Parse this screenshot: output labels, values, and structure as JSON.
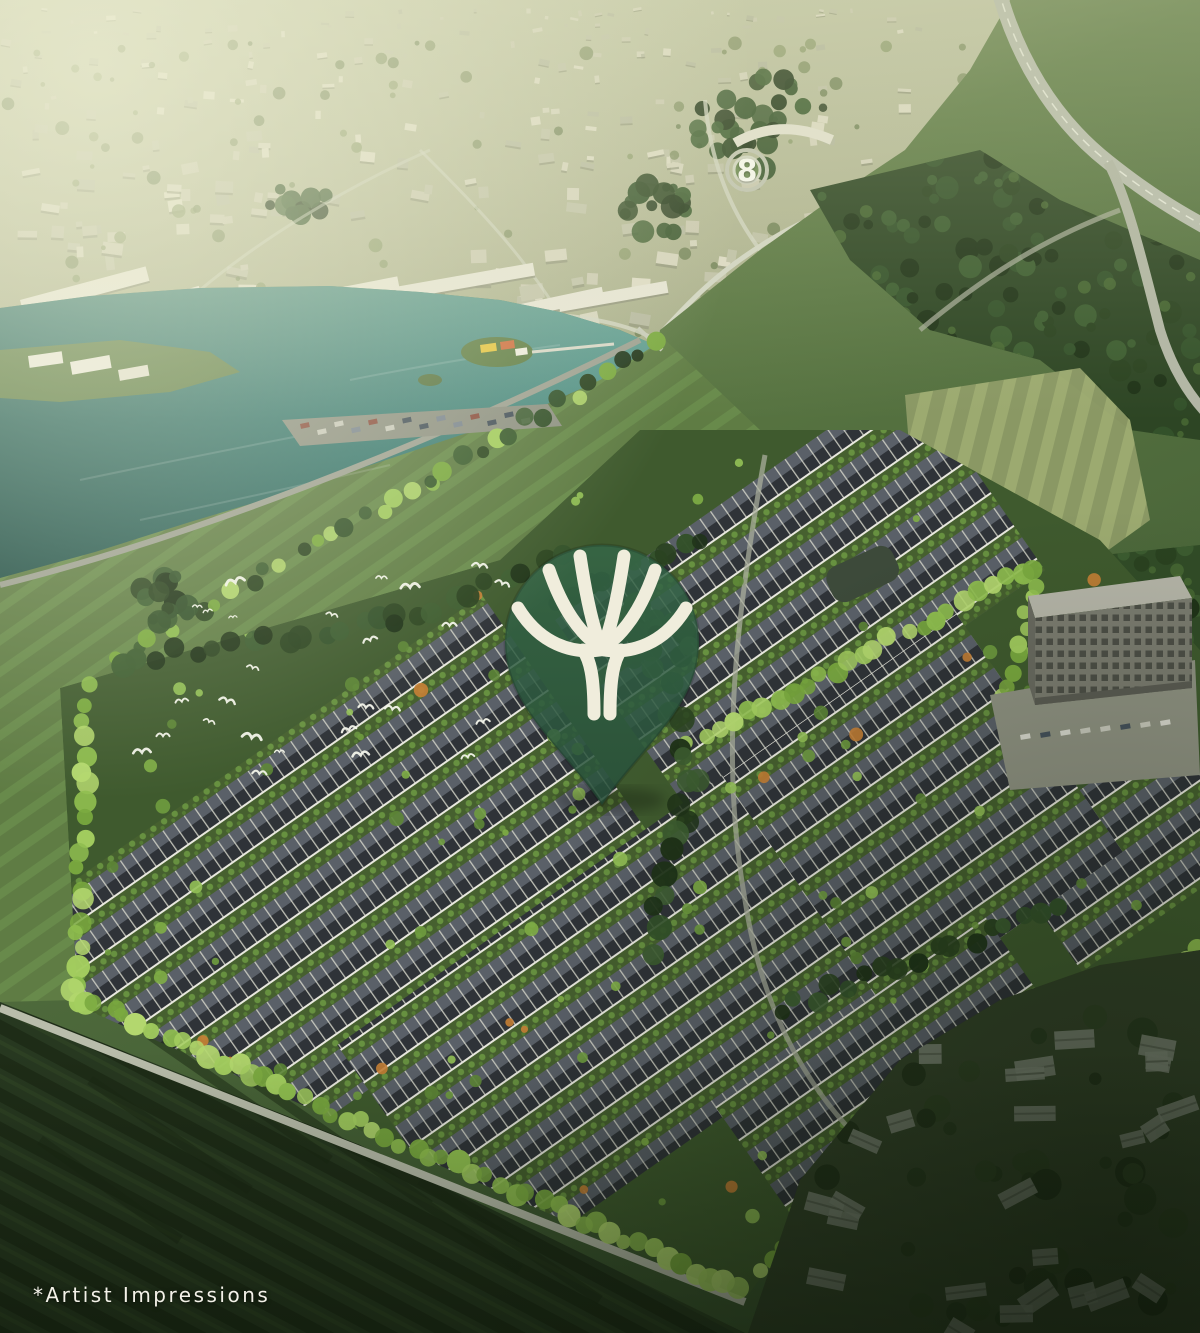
{
  "scene": {
    "type": "aerial-development-render",
    "caption": "*Artist Impressions",
    "roundabout_numeral": "8",
    "pin": {
      "icon": "tree-logo",
      "body_color": "#2e5c3b",
      "glyph_color": "#f0eddc"
    },
    "palette": {
      "haze": "#c6c9ac",
      "water": "#3f7d75",
      "meadow": "#5f7c44",
      "estate_green": "#3f5a2e",
      "roof_dark": "#2f3338",
      "roof_light": "#5a6068",
      "lime_trees": "#8fbe4f",
      "forest": "#2d4524",
      "dark_field": "#283920",
      "village": "#3b4b2f",
      "caption_color": "#f3f1e8"
    }
  }
}
